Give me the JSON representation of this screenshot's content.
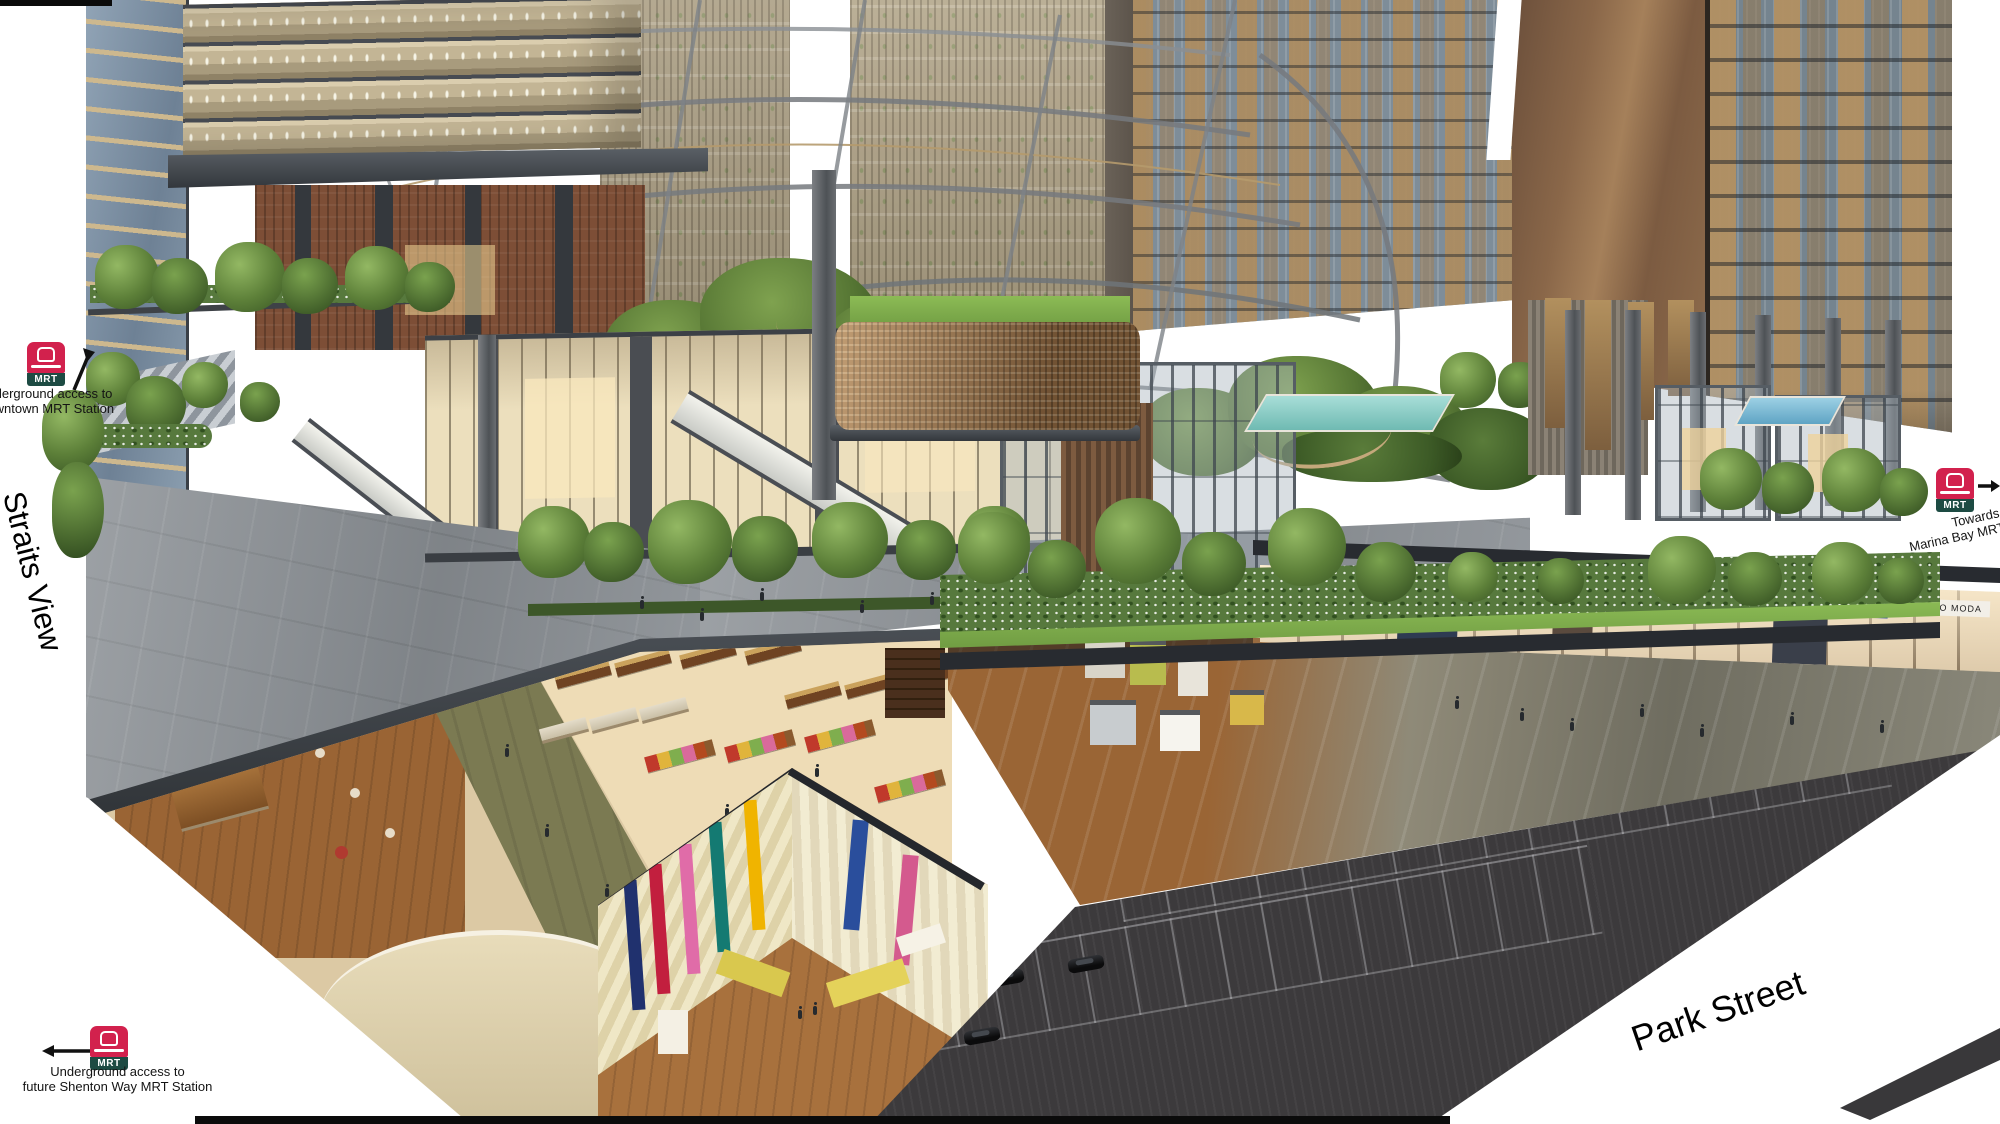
{
  "scene": {
    "type": "Architectural cutaway rendering",
    "description": "Aerial cutaway illustration of a mixed-use development showing office floors, residential towers around a landscaped green heart, street-level retail promenade, underground retail and carpark with MRT connections"
  },
  "street_labels": {
    "straits_view": "Straits View",
    "park_street": "Park Street"
  },
  "annotations": {
    "downtown_access": {
      "line1": "Underground access to",
      "line2": "Downtown MRT Station"
    },
    "marina_bay": {
      "line1": "Towards",
      "line2": "Marina Bay MRT Station"
    },
    "shenton_way": {
      "line1": "Underground access to",
      "line2": "future Shenton Way MRT Station"
    }
  },
  "mrt_badge": {
    "label": "MRT",
    "red": "#d2214d",
    "green": "#1d4b43"
  },
  "shop_signs": [
    {
      "text": "BAY"
    },
    {
      "text": "FILA"
    },
    {
      "text": "VERO MODA"
    }
  ],
  "colors": {
    "sky": "#ffffff",
    "annotation_text": "#141414",
    "asphalt": "#3c3a3c",
    "foliage": "#5f8340",
    "bronze_facade": "#9c7a52",
    "glass": "#8fa2b5",
    "plaza_paving": "#8d9297",
    "timber_floor": "#9a6434",
    "slab_edge": "#34383c",
    "pool": "#8fd0c8"
  }
}
